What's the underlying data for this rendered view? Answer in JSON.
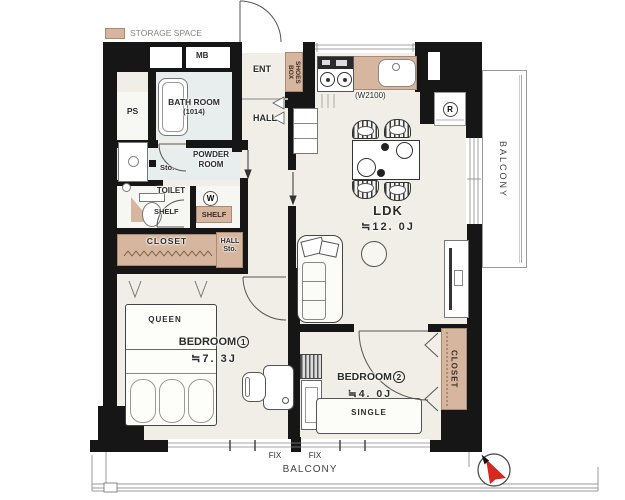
{
  "legend": {
    "label": "STORAGE SPACE",
    "swatch_color": "#d7b6a0"
  },
  "colors": {
    "wall": "#161616",
    "floor": "#f0eee6",
    "wet_floor": "#e8edee",
    "storage_tan": "#d7b6a0",
    "compass_red": "#d5281e"
  },
  "rooms": {
    "ent": {
      "label": "ENT"
    },
    "hall": {
      "label": "HALL"
    },
    "bath": {
      "name": "BATH ROOM",
      "size": "(1014)"
    },
    "powder": {
      "name": "POWDER ROOM"
    },
    "toilet": {
      "label": "TOILET"
    },
    "ldk": {
      "name": "LDK",
      "size": "≒12. 0J"
    },
    "bedroom1": {
      "name": "BEDROOM",
      "number": "1",
      "size": "≒7. 3J"
    },
    "bedroom2": {
      "name": "BEDROOM",
      "number": "2",
      "size": "≒4. 0J"
    },
    "balcony_right": {
      "label": "BALCONY"
    },
    "balcony_bottom": {
      "label": "BALCONY"
    }
  },
  "storage": {
    "shoes_box": "SHOES BOX",
    "closet_hall": "CLOSET",
    "closet_bedroom2": "CLOSET",
    "hall_sto_line1": "HALL",
    "hall_sto_line2": "Sto.",
    "sto": "Sto.",
    "toilet_shelf": "SHELF",
    "laundry_shelf": "SHELF"
  },
  "equipment": {
    "mb": "MB",
    "ps": "PS",
    "washer": "W",
    "fridge": "R",
    "kitchen_counter_width": "(W2100)"
  },
  "furniture": {
    "queen_bed": "QUEEN",
    "single_bed": "SINGLE"
  },
  "windows": {
    "fix_left": "FIX",
    "fix_right": "FIX"
  }
}
